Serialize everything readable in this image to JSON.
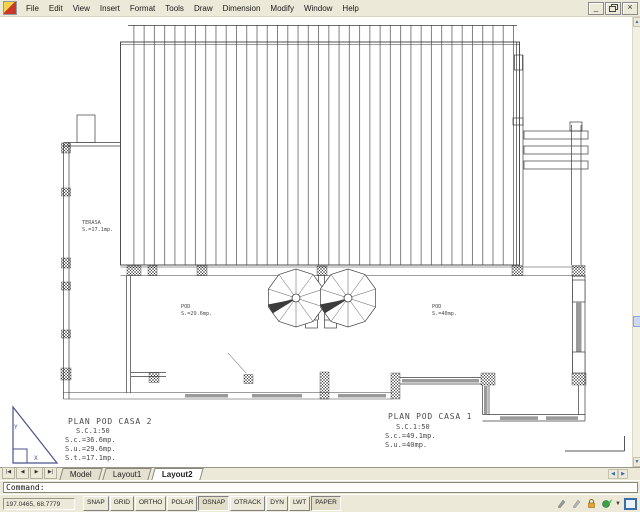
{
  "menu": {
    "items": [
      "File",
      "Edit",
      "View",
      "Insert",
      "Format",
      "Tools",
      "Draw",
      "Dimension",
      "Modify",
      "Window",
      "Help"
    ]
  },
  "window_controls": {
    "minimize": "_",
    "close": "×"
  },
  "drawing": {
    "labels": {
      "terasa": {
        "line1": "TERASA",
        "line2": "S.=17.1mp."
      },
      "pod_left": {
        "line1": "POD",
        "line2": "S.=29.6mp."
      },
      "pod_right": {
        "line1": "POD",
        "line2": "S.=40mp."
      },
      "casa2": {
        "title": "PLAN POD CASA 2",
        "scale": "S.C.1:50",
        "sc": "S.c.=36.6mp.",
        "su": "S.u.=29.6mp.",
        "st": "S.t.=17.1mp."
      },
      "casa1": {
        "title": "PLAN POD CASA 1",
        "scale": "S.C.1:50",
        "sc": "S.c.=49.1mp.",
        "su": "S.u.=40mp."
      }
    },
    "ucs": {
      "x": "X",
      "y": "Y"
    }
  },
  "scroll": {
    "up": "▲",
    "down": "▼",
    "left": "◀",
    "right": "▶"
  },
  "tabs": {
    "nav": [
      "|◀",
      "◀",
      "▶",
      "▶|"
    ],
    "items": [
      {
        "label": "Model"
      },
      {
        "label": "Layout1"
      },
      {
        "label": "Layout2"
      }
    ],
    "active": "Layout2"
  },
  "command": {
    "prompt": "Command:"
  },
  "statusbar": {
    "coordinates": "197.0465, 68.7779",
    "toggles": [
      {
        "label": "SNAP",
        "on": false
      },
      {
        "label": "GRID",
        "on": false
      },
      {
        "label": "ORTHO",
        "on": false
      },
      {
        "label": "POLAR",
        "on": false
      },
      {
        "label": "OSNAP",
        "on": true
      },
      {
        "label": "OTRACK",
        "on": false
      },
      {
        "label": "DYN",
        "on": false
      },
      {
        "label": "LWT",
        "on": false
      },
      {
        "label": "PAPER",
        "on": true
      }
    ],
    "tray_icons": [
      "pencil",
      "pencil",
      "lock",
      "communication-center",
      "tray-arrow",
      "clean-screen"
    ]
  },
  "colors": {
    "chrome": "#ece9d8",
    "line": "#3c3c3c",
    "ucs": "#4a5389",
    "scroll_accent": "#3a6ea5"
  }
}
